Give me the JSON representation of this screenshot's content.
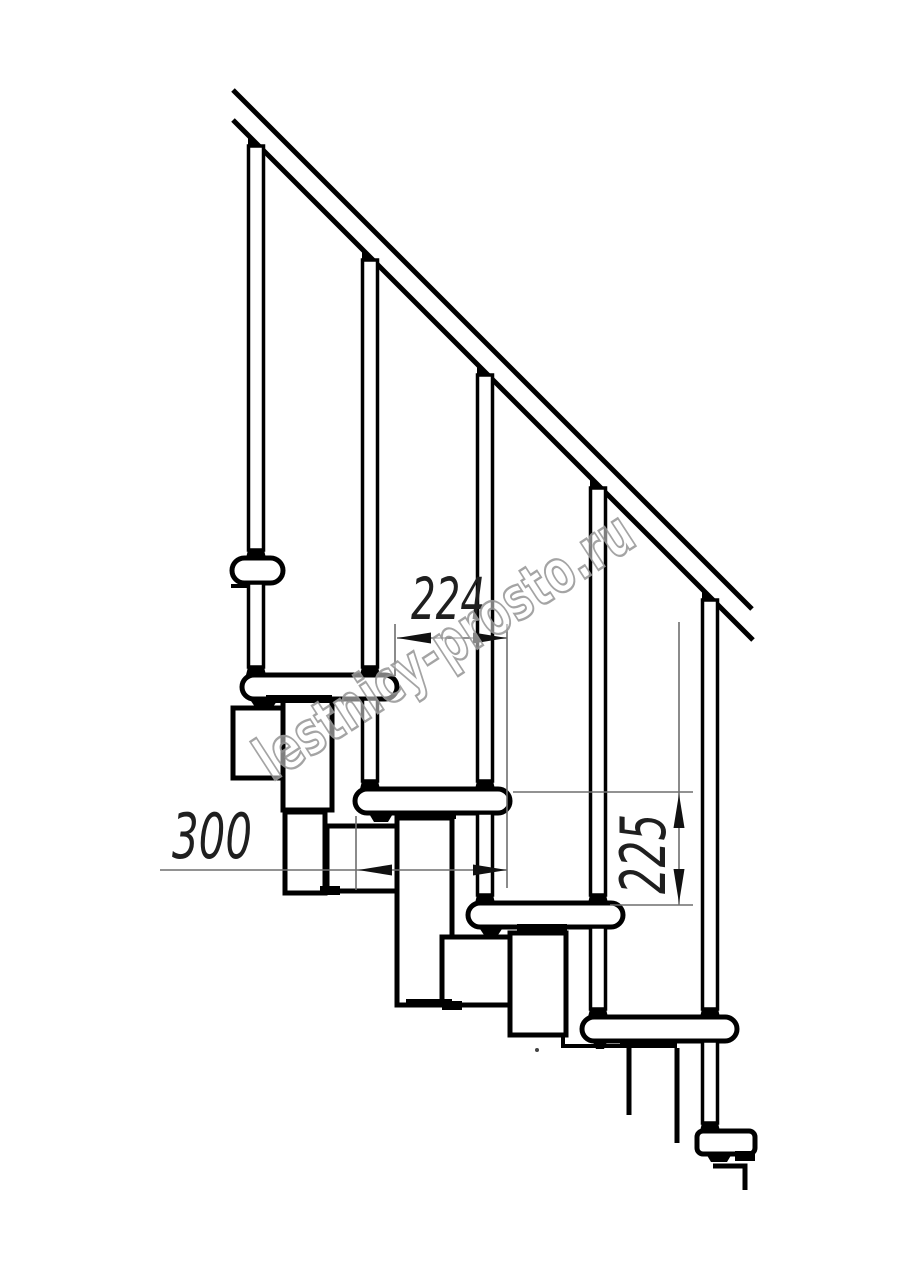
{
  "drawing": {
    "description": "Side-view fragment of a modular staircase: diagonal handrail, five balusters, overlapping treads and stringer modules, with three dimension callouts",
    "labels": {
      "run": "224",
      "tread": "300",
      "rise": "225"
    },
    "watermark": {
      "text": "lestnicy-prosto.ru"
    },
    "colors": {
      "background": "#ffffff",
      "line": "#000000",
      "dim_text": "#1f1f1f",
      "watermark_stroke": "#9b9b9b"
    }
  }
}
